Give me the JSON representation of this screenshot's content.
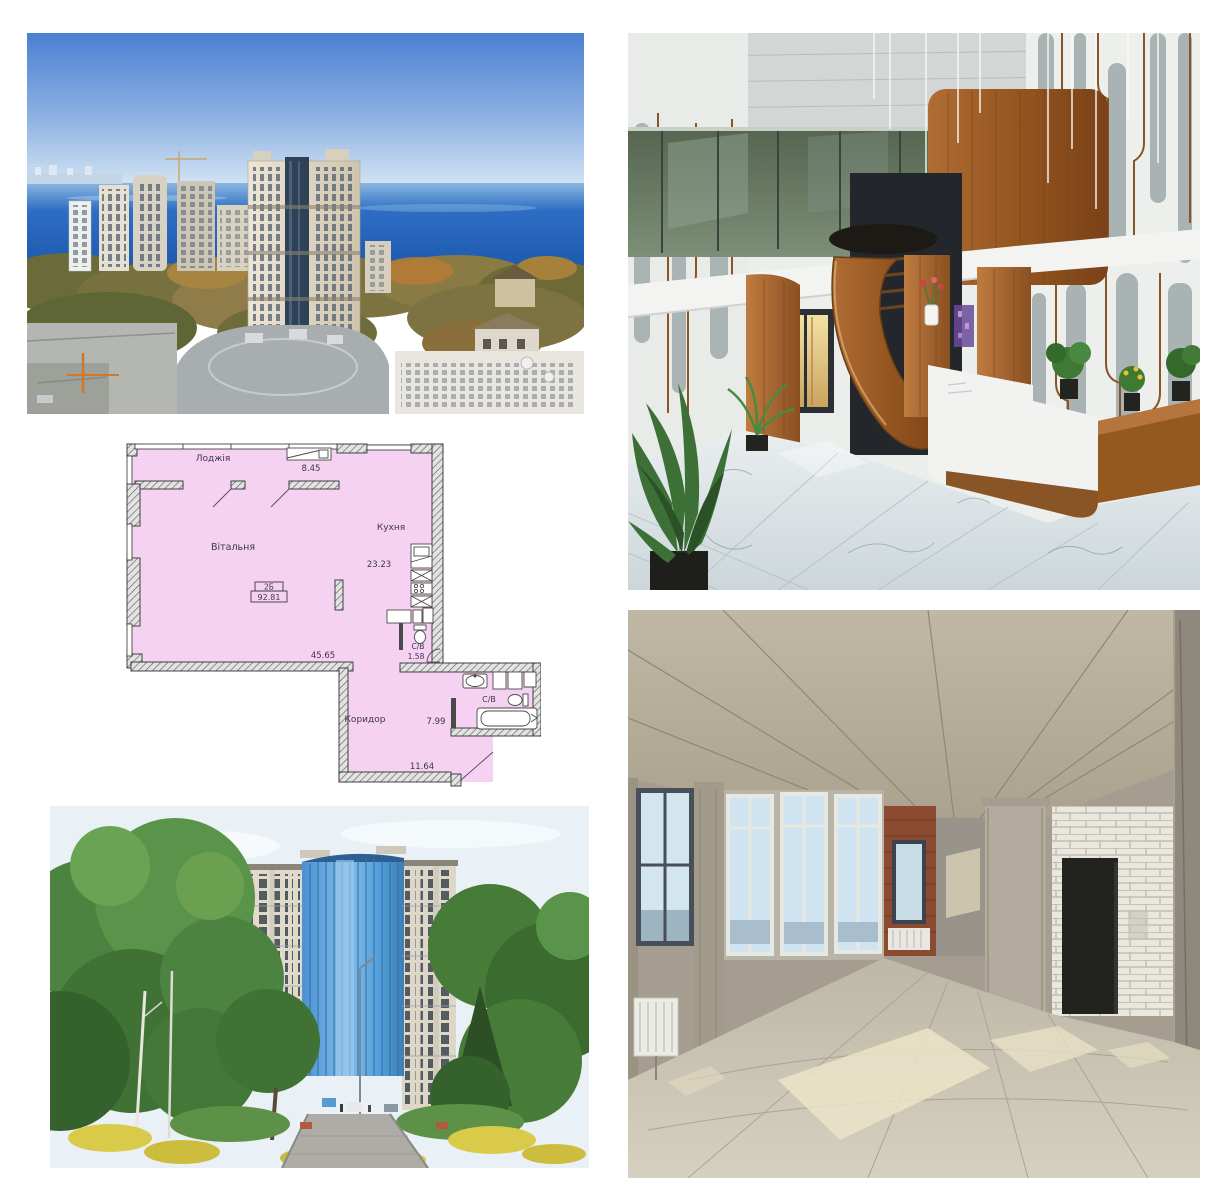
{
  "collage": {
    "background": "#ffffff",
    "photos": {
      "aerial": {
        "label": "aerial-sea-view-cityscape"
      },
      "lobby": {
        "label": "lobby-spiral-staircase-reception"
      },
      "park": {
        "label": "high-rise-from-park"
      },
      "shell": {
        "label": "unfinished-concrete-interior"
      }
    }
  },
  "floor_plan": {
    "unit_type": "2Б",
    "total_area": "92.81",
    "rooms": {
      "loggia": {
        "name": "Лоджія",
        "area": "8.45"
      },
      "living": {
        "name": "Вітальня",
        "area": "45.65"
      },
      "kitchen": {
        "name": "Кухня",
        "area": "23.23"
      },
      "wc": {
        "name": "С/В",
        "area": "1.58"
      },
      "bathroom": {
        "name": "С/В",
        "area": "7.99"
      },
      "corridor": {
        "name": "Коридор",
        "area": "11.64"
      }
    },
    "colors": {
      "room_fill": "#f6d2f2",
      "wall": "#3a3a3a",
      "text": "#3d3548"
    }
  }
}
